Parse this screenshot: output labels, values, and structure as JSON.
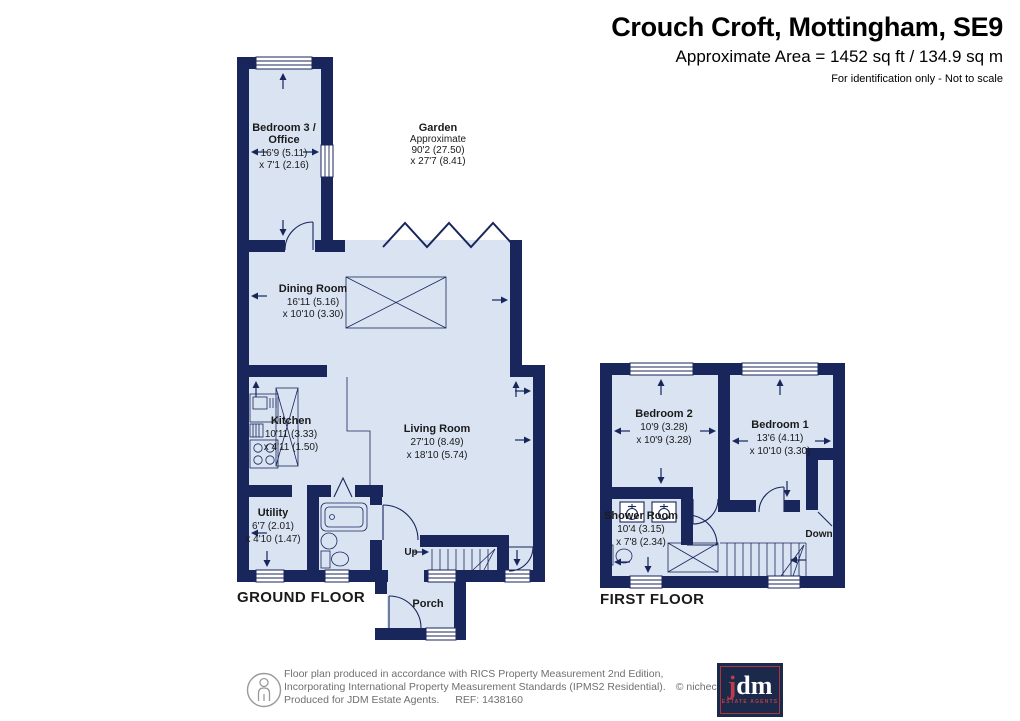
{
  "header": {
    "title": "Crouch Croft, Mottingham, SE9",
    "area": "Approximate Area = 1452 sq ft / 134.9 sq m",
    "note": "For identification only - Not to scale"
  },
  "ground_floor": {
    "label": "GROUND FLOOR",
    "stairs_label": "Up",
    "bedroom3": {
      "line1": "Bedroom 3 /",
      "line2": "Office",
      "dim1": "16'9 (5.11)",
      "dim2": "x 7'1 (2.16)"
    },
    "garden": {
      "name": "Garden",
      "qualifier": "Approximate",
      "dim1": "90'2 (27.50)",
      "dim2": "x 27'7 (8.41)"
    },
    "dining_room": {
      "name": "Dining Room",
      "dim1": "16'11 (5.16)",
      "dim2": "x 10'10 (3.30)"
    },
    "kitchen": {
      "name": "Kitchen",
      "dim1": "10'11 (3.33)",
      "dim2": "x 4'11 (1.50)"
    },
    "living_room": {
      "name": "Living Room",
      "dim1": "27'10 (8.49)",
      "dim2": "x 18'10 (5.74)"
    },
    "utility": {
      "name": "Utility",
      "dim1": "6'7 (2.01)",
      "dim2": "x 4'10 (1.47)"
    },
    "porch": {
      "name": "Porch"
    }
  },
  "first_floor": {
    "label": "FIRST FLOOR",
    "stairs_label": "Down",
    "bedroom2": {
      "name": "Bedroom 2",
      "dim1": "10'9 (3.28)",
      "dim2": "x 10'9 (3.28)"
    },
    "bedroom1": {
      "name": "Bedroom 1",
      "dim1": "13'6 (4.11)",
      "dim2": "x 10'10 (3.30)"
    },
    "shower_room": {
      "name": "Shower Room",
      "dim1": "10'4 (3.15)",
      "dim2": "x 7'8 (2.34)"
    }
  },
  "footer": {
    "line1": "Floor plan produced in accordance with RICS Property Measurement 2nd Edition,",
    "line2": "Incorporating International Property Measurement Standards (IPMS2 Residential).",
    "copyright": "© nichecom 2026.",
    "produced": "Produced for JDM Estate Agents.",
    "ref": "REF: 1438160",
    "logo": {
      "j": "j",
      "dm": "dm",
      "tagline": "ESTATE AGENTS"
    }
  },
  "colors": {
    "wall": "#18265B",
    "floor": "#D9E3F2",
    "logo_navy": "#1B2A4A",
    "logo_red": "#BF3B47"
  }
}
